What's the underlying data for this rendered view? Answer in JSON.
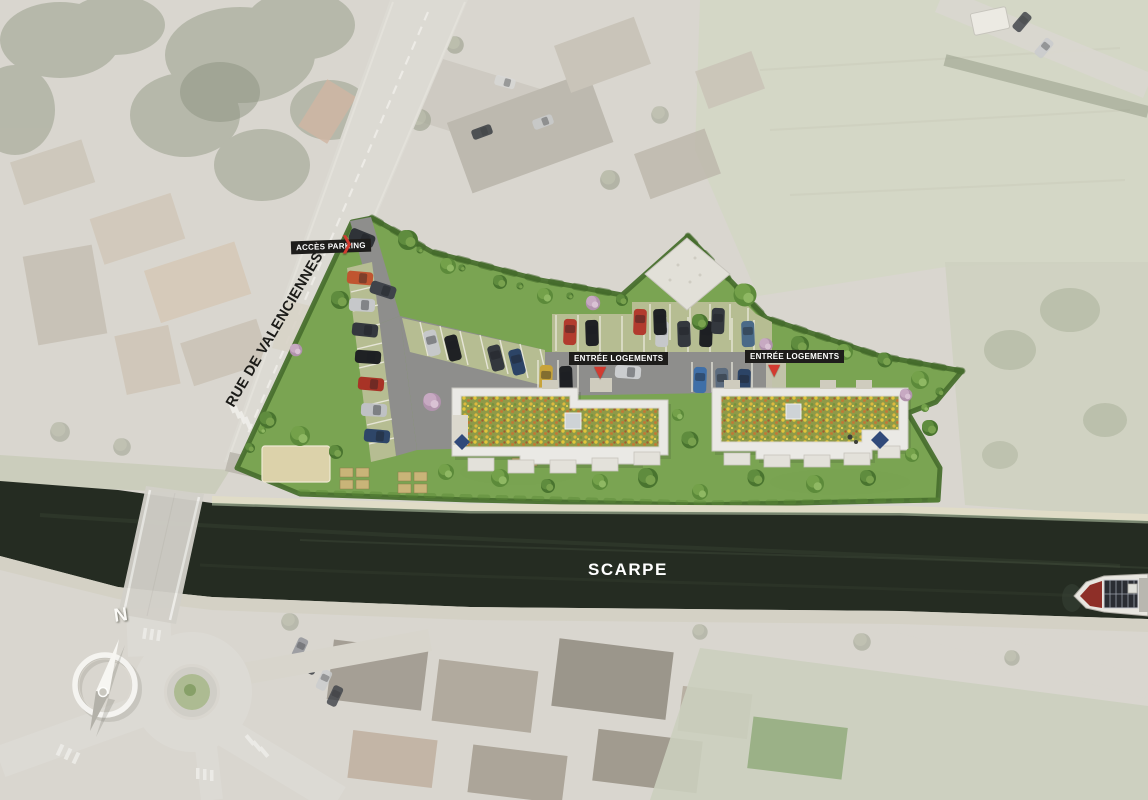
{
  "map": {
    "kind": "residential-development-site-plan-on-faded-aerial-photo",
    "labels": {
      "access_parking": "ACCÈS PARKING",
      "street_name": "RUE DE VALENCIENNES",
      "housing_entrance_west": "ENTRÉE LOGEMENTS",
      "housing_entrance_east": "ENTRÉE LOGEMENTS",
      "waterway_name": "SCARPE",
      "compass_north": "N"
    },
    "glyphs": {
      "access_parking_arrow": "❯",
      "housing_entrance_arrow": "▼"
    },
    "colors": {
      "label_background": "#1e1d1b",
      "label_text": "#ffffff",
      "marker_red": "#d23b30",
      "canal_water": "#252c22",
      "site_lawn": "#7aa452",
      "flowered_roof_base": "#8f9a48",
      "faded_surroundings": "#d9d6cf"
    },
    "features": {
      "buildings": 2,
      "building_roof": "green roof covered with yellow-orange flowers",
      "waterway": "canal with barge at right edge",
      "junction": "roundabout at lower left",
      "compass": "north arrow compass rose"
    }
  }
}
